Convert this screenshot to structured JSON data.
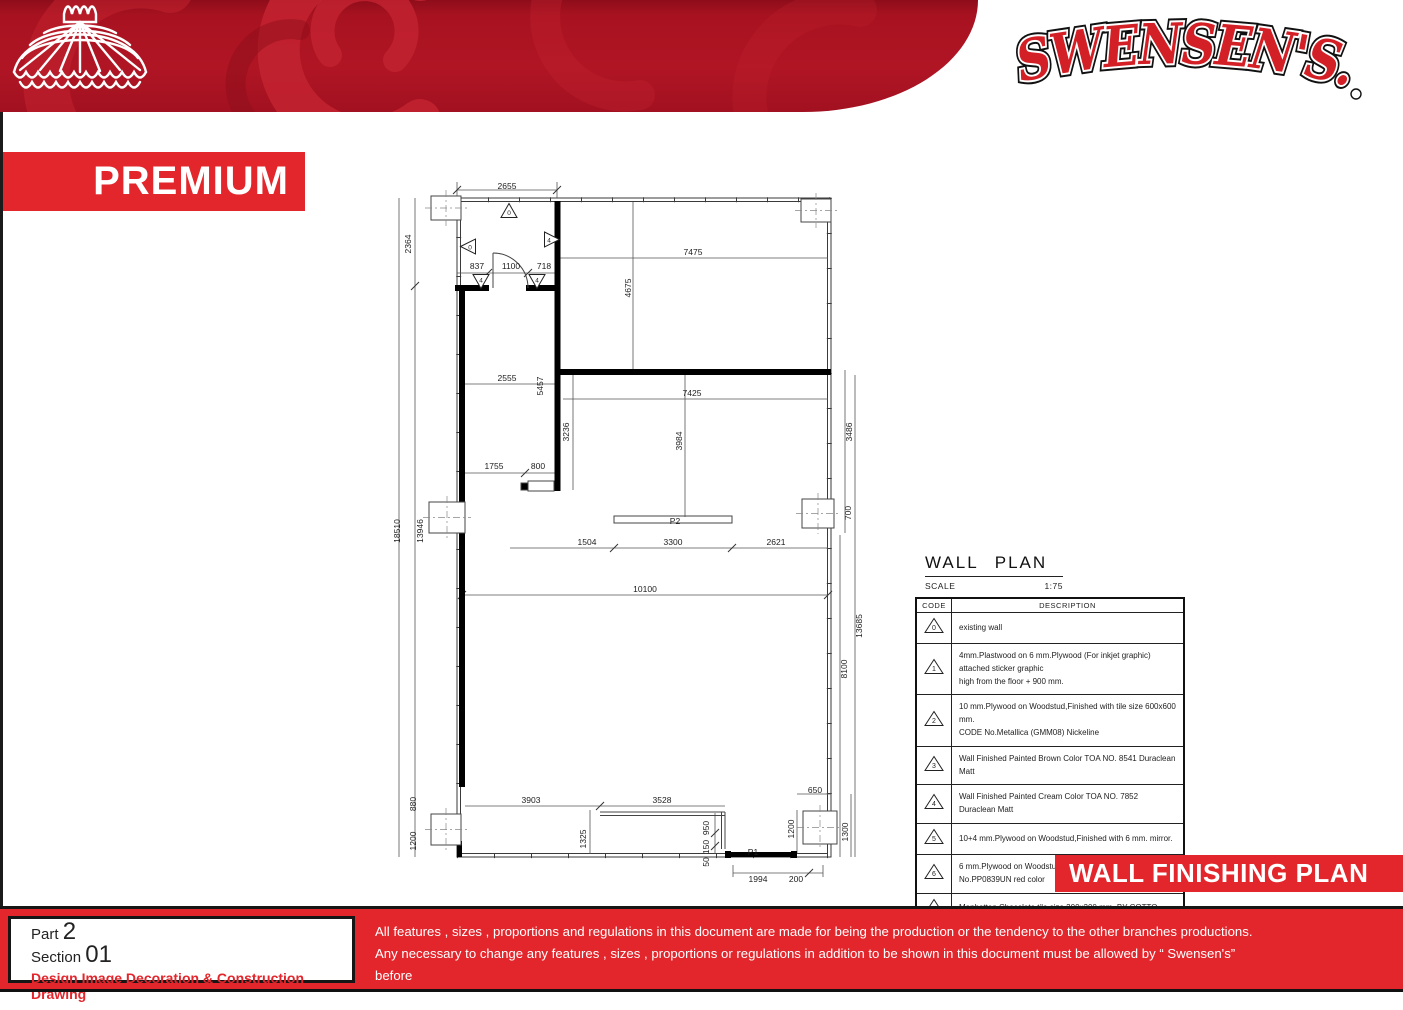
{
  "colors": {
    "brand_red": "#e2262c",
    "logo_red": "#d31f26",
    "header_base": "#a81220",
    "header_swirl": "#c22230"
  },
  "header": {
    "brand_name": "SWENSEN'S.",
    "premium_label": "PREMIUM",
    "lamp_icon": "swensens-lamp-icon"
  },
  "banner": {
    "label": "WALL FINISHING PLAN"
  },
  "wall_plan": {
    "title": "WALL PLAN",
    "scale_label": "SCALE",
    "scale_value": "1:75",
    "table": {
      "headers": [
        "CODE",
        "DESCRIPTION"
      ],
      "rows": [
        {
          "code": "0",
          "description": "existing wall"
        },
        {
          "code": "1",
          "description": "4mm.Plastwood on 6 mm.Plywood (For inkjet graphic) attached sticker graphic\nhigh from the floor + 900 mm."
        },
        {
          "code": "2",
          "description": "10 mm.Plywood on Woodstud,Finished with tile size 600x600 mm.\nCODE No.Metallica (GMM08) Nickeline"
        },
        {
          "code": "3",
          "description": "Wall Finished Painted Brown Color  TOA NO. 8541 Duraclean Matt"
        },
        {
          "code": "4",
          "description": "Wall Finished Painted Cream Color  TOA NO. 7852 Duraclean Matt"
        },
        {
          "code": "5",
          "description": "10+4 mm.Plywood on Woodstud,Finished with 6 mm. mirror."
        },
        {
          "code": "6",
          "description": "6 mm.Plywood on Woodstud,Finished with Laminate Formica No.PP0839UN red color"
        },
        {
          "code": "7",
          "description": "Manhattan Chocolate tile size 200x200 mm. BY COTTO"
        }
      ]
    }
  },
  "plan": {
    "dimensions": [
      {
        "t": "2655",
        "x": 122,
        "y": 21
      },
      {
        "t": "2364",
        "x": 23,
        "y": 79,
        "r": -90
      },
      {
        "t": "837",
        "x": 92,
        "y": 101
      },
      {
        "t": "1100",
        "x": 126,
        "y": 101
      },
      {
        "t": "718",
        "x": 159,
        "y": 101
      },
      {
        "t": "7475",
        "x": 308,
        "y": 87
      },
      {
        "t": "4675",
        "x": 243,
        "y": 123,
        "r": -90
      },
      {
        "t": "2555",
        "x": 122,
        "y": 213
      },
      {
        "t": "5457",
        "x": 155,
        "y": 221,
        "r": -90
      },
      {
        "t": "3236",
        "x": 181,
        "y": 267,
        "r": -90
      },
      {
        "t": "7425",
        "x": 307,
        "y": 228
      },
      {
        "t": "3984",
        "x": 294,
        "y": 276,
        "r": -90
      },
      {
        "t": "3486",
        "x": 464,
        "y": 267,
        "r": -90
      },
      {
        "t": "1755",
        "x": 109,
        "y": 301
      },
      {
        "t": "800",
        "x": 153,
        "y": 301
      },
      {
        "t": "700",
        "x": 463,
        "y": 348,
        "r": -90
      },
      {
        "t": "P2",
        "x": 290,
        "y": 356
      },
      {
        "t": "1504",
        "x": 202,
        "y": 377
      },
      {
        "t": "3300",
        "x": 288,
        "y": 377
      },
      {
        "t": "2621",
        "x": 391,
        "y": 377
      },
      {
        "t": "10100",
        "x": 260,
        "y": 424
      },
      {
        "t": "18510",
        "x": 12,
        "y": 366,
        "r": -90
      },
      {
        "t": "13946",
        "x": 35,
        "y": 366,
        "r": -90
      },
      {
        "t": "13685",
        "x": 474,
        "y": 461,
        "r": -90
      },
      {
        "t": "8100",
        "x": 459,
        "y": 504,
        "r": -90
      },
      {
        "t": "880",
        "x": 28,
        "y": 639,
        "r": -90
      },
      {
        "t": "1200",
        "x": 28,
        "y": 676,
        "r": -90
      },
      {
        "t": "3903",
        "x": 146,
        "y": 635
      },
      {
        "t": "3528",
        "x": 277,
        "y": 635
      },
      {
        "t": "650",
        "x": 430,
        "y": 625
      },
      {
        "t": "1325",
        "x": 198,
        "y": 674,
        "r": -90
      },
      {
        "t": "950",
        "x": 321,
        "y": 663,
        "r": -90
      },
      {
        "t": "150",
        "x": 321,
        "y": 682,
        "r": -90
      },
      {
        "t": "50",
        "x": 321,
        "y": 697,
        "r": -90
      },
      {
        "t": "P1",
        "x": 368,
        "y": 687
      },
      {
        "t": "1994",
        "x": 373,
        "y": 714
      },
      {
        "t": "200",
        "x": 411,
        "y": 714
      },
      {
        "t": "1200",
        "x": 406,
        "y": 664,
        "r": -90
      },
      {
        "t": "1300",
        "x": 460,
        "y": 667,
        "r": -90
      }
    ],
    "markers": [
      {
        "code": "0",
        "dir": "up",
        "x": 124,
        "y": 45
      },
      {
        "code": "0",
        "dir": "left",
        "x": 83,
        "y": 81
      },
      {
        "code": "4",
        "dir": "right",
        "x": 166,
        "y": 74
      },
      {
        "code": "4",
        "dir": "down",
        "x": 96,
        "y": 116
      },
      {
        "code": "4",
        "dir": "down",
        "x": 152,
        "y": 116
      }
    ]
  },
  "footer": {
    "part_label": "Part",
    "part_value": "2",
    "section_label": "Section",
    "section_value": "01",
    "subtitle": "Design Image Decoration & Construction Drawing",
    "disclaimer_lines": [
      "All features , sizes , proportions and regulations in this document are made for being the production or the tendency to the other branches productions.",
      "Any necessary to change any features , sizes , proportions or regulations in addition to be shown in this document must be allowed by “ Swensen's” before",
      "any procedure."
    ]
  }
}
